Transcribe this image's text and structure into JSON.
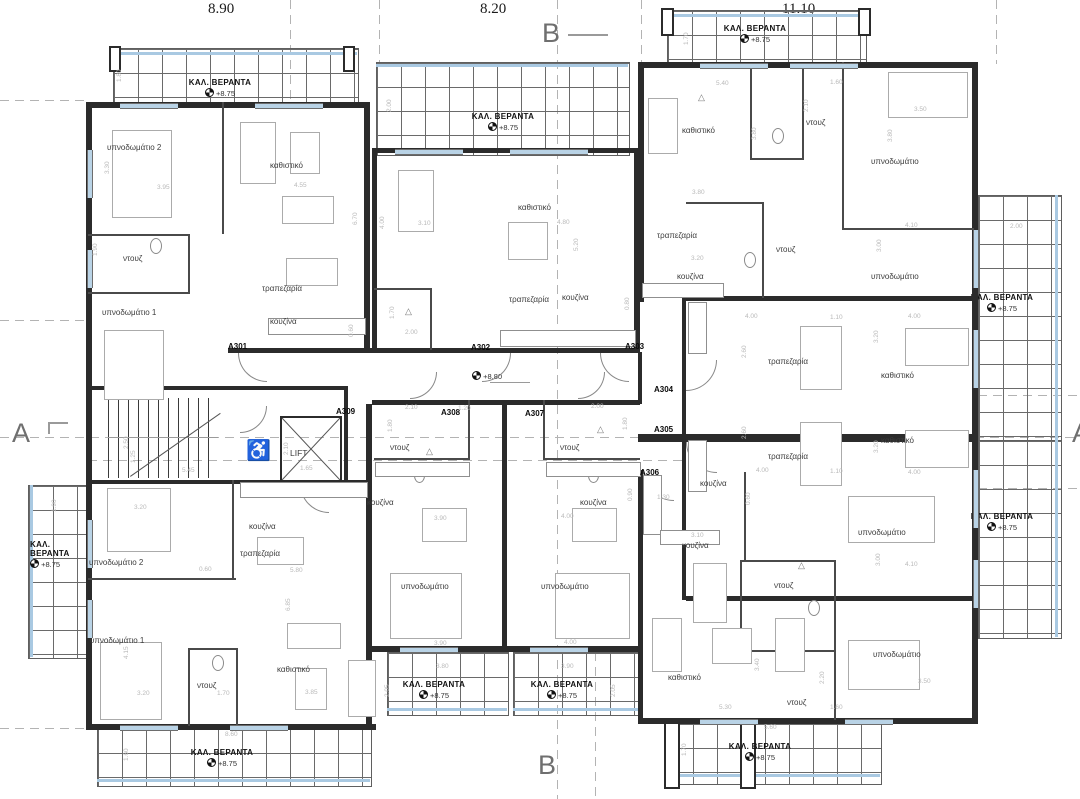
{
  "plan": {
    "top_dims": [
      "8.90",
      "8.20",
      "11.10"
    ],
    "markers": {
      "top": "B",
      "bottom": "B",
      "left": "A",
      "right": "A"
    },
    "core": {
      "lift": "LIFT",
      "corridor_level": "+8.80"
    },
    "veranda": {
      "name": "ΚΑΛ. ΒΕΡΑΝΤΑ",
      "kal": "ΚΑΛ.",
      "veranta": "ΒΕΡΑΝΤΑ",
      "level": "+8.75"
    },
    "apts": [
      "A301",
      "A302",
      "A303",
      "A304",
      "A305",
      "A306",
      "A307",
      "A308",
      "A309"
    ],
    "rooms": [
      "υπνοδωμάτιο 2",
      "καθιστικό",
      "ντουζ",
      "υπνοδωμάτιο 1",
      "τραπεζαρία",
      "κουζίνα",
      "καθιστικό",
      "τραπεζαρία",
      "κουζίνα",
      "καθιστικό",
      "ντουζ",
      "υπνοδωμάτιο",
      "τραπεζαρία",
      "κουζίνα",
      "ντουζ",
      "υπνοδωμάτιο",
      "τραπεζαρία",
      "καθιστικό",
      "τραπεζαρία",
      "καθιστικό",
      "κουζίνα",
      "κουζίνα",
      "ντουζ",
      "υπνοδωμάτιο",
      "καθιστικό",
      "ντουζ",
      "υπνοδωμάτιο",
      "ντουζ",
      "κουζίνα",
      "υπνοδωμάτιο",
      "ντουζ",
      "κουζίνα",
      "υπνοδωμάτιο",
      "υπνοδωμάτιο 2",
      "υπνοδωμάτιο 1",
      "κουζίνα",
      "τραπεζαρία",
      "ντουζ",
      "καθιστικό"
    ],
    "dims": [
      "1.80",
      "3.30",
      "3.95",
      "4.55",
      "6.70",
      "1.90",
      "2.00",
      "4.00",
      "3.10",
      "4.80",
      "5.20",
      "3.80",
      "3.20",
      "1.70",
      "5.40",
      "1.60",
      "2.10",
      "3.50",
      "3.80",
      "3.80",
      "4.10",
      "3.00",
      "2.00",
      "4.00",
      "1.10",
      "2.60",
      "3.20",
      "4.00",
      "4.00",
      "1.10",
      "2.60",
      "3.20",
      "4.00",
      "3.10",
      "3.00",
      "4.10",
      "3.50",
      "3.40",
      "5.30",
      "1.60",
      "2.20",
      "5.60",
      "1.70",
      "2.10",
      "1.20",
      "1.80",
      "2.00",
      "1.80",
      "1.30",
      "0.90",
      "3.90",
      "4.00",
      "3.90",
      "4.00",
      "3.80",
      "3.90",
      "2.05",
      "2.05",
      "3.20",
      "0.60",
      "5.80",
      "6.85",
      "5.45",
      "2.50",
      "1.25",
      "2.10",
      "1.65",
      "4.15",
      "3.20",
      "1.70",
      "3.85",
      "8.60",
      "1.60",
      "1.90",
      "2.00",
      "1.70",
      "0.60",
      "0.80",
      "0.60"
    ]
  }
}
